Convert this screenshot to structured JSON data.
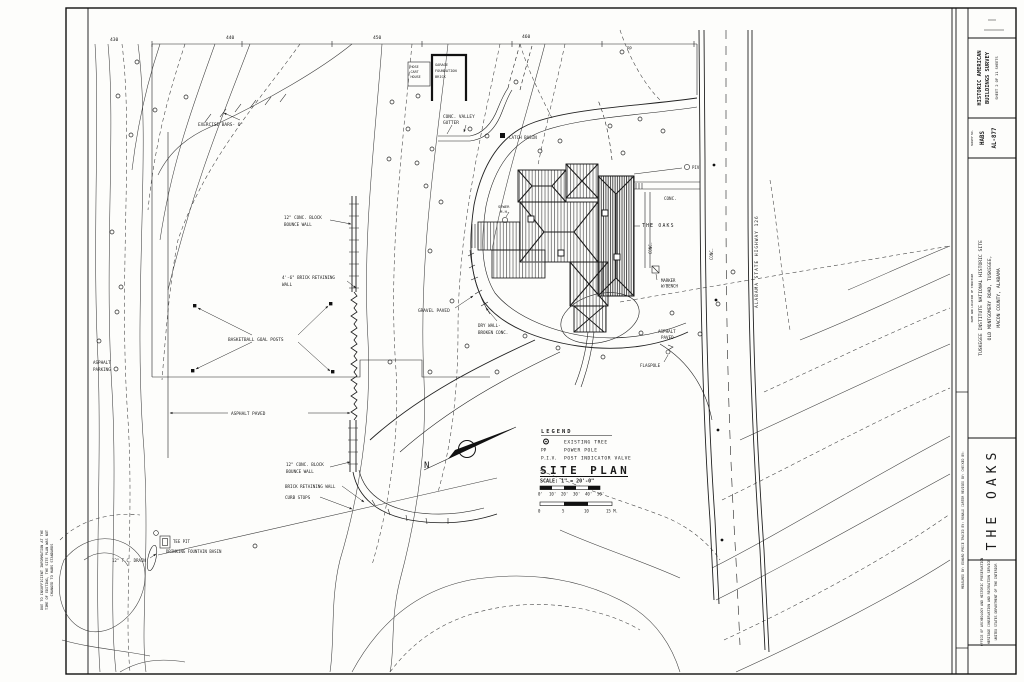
{
  "title_block": {
    "survey": {
      "line1": "HISTORIC AMERICAN",
      "line2": "BUILDINGS SURVEY",
      "sheet_line": "SHEET 2 OF 11 SHEETS"
    },
    "survey_no": {
      "label": "SURVEY NO.",
      "value1": "HABS",
      "value2": "AL-877"
    },
    "location": {
      "header": "NAME AND LOCATION OF STRUCTURE",
      "line1": "TUSKEGEE INSTITUTE NATIONAL HISTORIC SITE",
      "line2": "OLD MONTGOMERY ROAD, TUSKEGEE,",
      "line3": "MACON COUNTY, ALABAMA"
    },
    "structure_name": "THE OAKS",
    "agency": [
      "OFFICE OF ARCHEOLOGY AND HISTORIC PRESERVATION",
      "HERITAGE CONSERVATION AND RECREATION SERVICE",
      "UNITED STATES DEPARTMENT OF THE INTERIOR"
    ],
    "credits": "MEASURED BY: EDWARD PRICE     TRACED BY: RONALD CARTER     REVISED BY:     CHECKED BY:"
  },
  "margin_note": [
    "DUE TO INSUFFICIENT INFORMATION AT THE",
    "TIME OF EDITING, THE SITE PLAN WAS NOT",
    "CHANGED TO HABS STANDARDS"
  ],
  "plan": {
    "title": "SITE PLAN",
    "scale": "SCALE: 1\" = 20'-0\""
  },
  "legend": {
    "title": "LEGEND",
    "item1": "EXISTING TREE",
    "sym2": "PP",
    "item2": "POWER POLE",
    "sym3": "P.I.V.",
    "item3": "POST INDICATOR VALVE"
  },
  "scale_bars": {
    "imperial": [
      "0'",
      "10'",
      "20'",
      "30'",
      "40'",
      "50'"
    ],
    "metric": [
      "0",
      "5",
      "10",
      "15 M."
    ]
  },
  "north": "N",
  "labels": {
    "c430": "430",
    "c440": "440",
    "c450": "450",
    "c460": "460",
    "exercise": "EXERCISE BARS- 6\"",
    "hose": [
      "HOSE",
      "CART",
      "HOUSE"
    ],
    "garage": [
      "GARAGE",
      "FOUNDATION",
      "BRICK"
    ],
    "gutter": [
      "CONC. VALLEY",
      "GUTTER"
    ],
    "catch_basin": "CATCH BASIN",
    "pp": "PP",
    "sewer": [
      "SEWER",
      "M.H."
    ],
    "the_oaks": "THE OAKS",
    "conc_front": "CONC.",
    "conc_walk_s": "CONC.",
    "conc_sidewalk": "CONC.",
    "piv": "PIV",
    "marker": [
      "MARKER",
      "W/BENCH"
    ],
    "highway": "ALABAMA STATE HIGHWAY 126",
    "gravel": "GRAVEL PAVED",
    "drywall": [
      "DRY WALL-",
      "BROKEN CONC."
    ],
    "asphalt_e": [
      "ASPHALT",
      "PAVED"
    ],
    "flagpole": "FLAGPOLE",
    "parking": [
      "ASPHALT",
      "PARKING"
    ],
    "basketball": "BASKETBALL GOAL POSTS",
    "asphalt_c": "ASPHALT PAVED",
    "bounce_u": [
      "12\" CONC. BLOCK",
      "BOUNCE WALL"
    ],
    "brick_u": [
      "4'-6\" BRICK RETAINING",
      "WALL"
    ],
    "bounce_l": [
      "12\" CONC. BLOCK",
      "BOUNCE WALL"
    ],
    "brick_l": "BRICK RETAINING WALL",
    "curb": "CURB STOPS",
    "tee": "TEE PIT",
    "fountain": "DRINKING FOUNTAIN BASIN",
    "drain": "12\" T.C. DRAIN"
  }
}
